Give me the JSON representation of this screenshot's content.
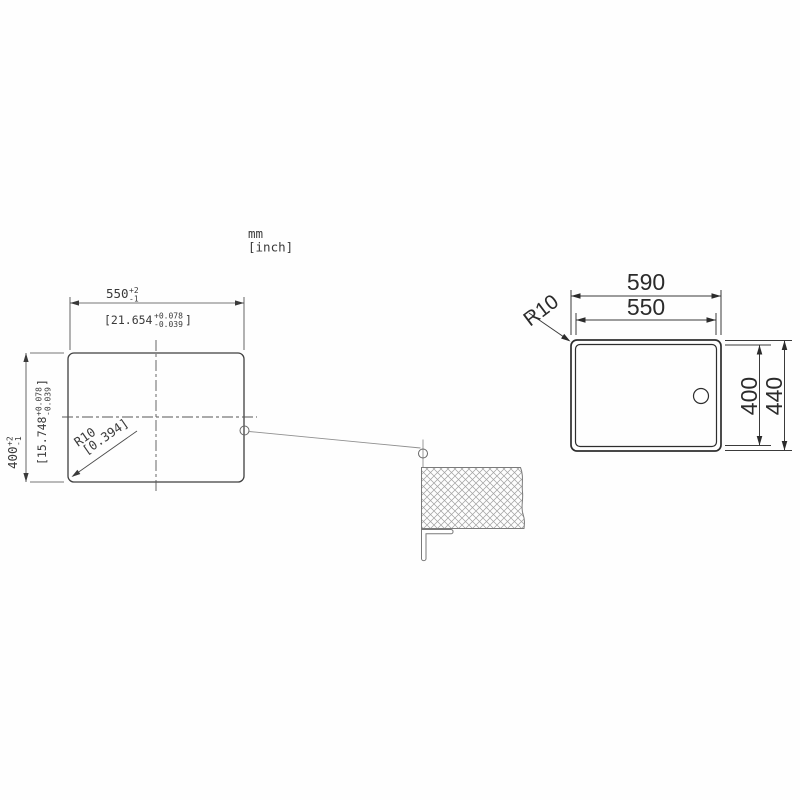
{
  "note": {
    "mm": "mm",
    "inch": "[inch]"
  },
  "cutout_view": {
    "width_mm": "550",
    "width_mm_tol_up": "+2",
    "width_mm_tol_dn": "-1",
    "width_in_open": "[21.654",
    "width_in_tol_up": "+0.078",
    "width_in_tol_dn": "-0.039",
    "width_in_close": "]",
    "height_mm": "400",
    "height_mm_tol_up": "+2",
    "height_mm_tol_dn": "-1",
    "height_in_open": "[15.748",
    "height_in_tol_up": "+0.078",
    "height_in_tol_dn": "-0.039",
    "height_in_close": "]",
    "radius_mm": "R10",
    "radius_in": "[0.394]"
  },
  "sink_view": {
    "outer_width": "590",
    "inner_width": "550",
    "inner_height": "400",
    "outer_height": "440",
    "radius": "R10"
  },
  "colors": {
    "line": "#3a3a3a",
    "line_bold": "#2e2e2e",
    "hatch": "#a3a3a3",
    "leader": "#8f8f8f",
    "background": "#fefefe"
  }
}
